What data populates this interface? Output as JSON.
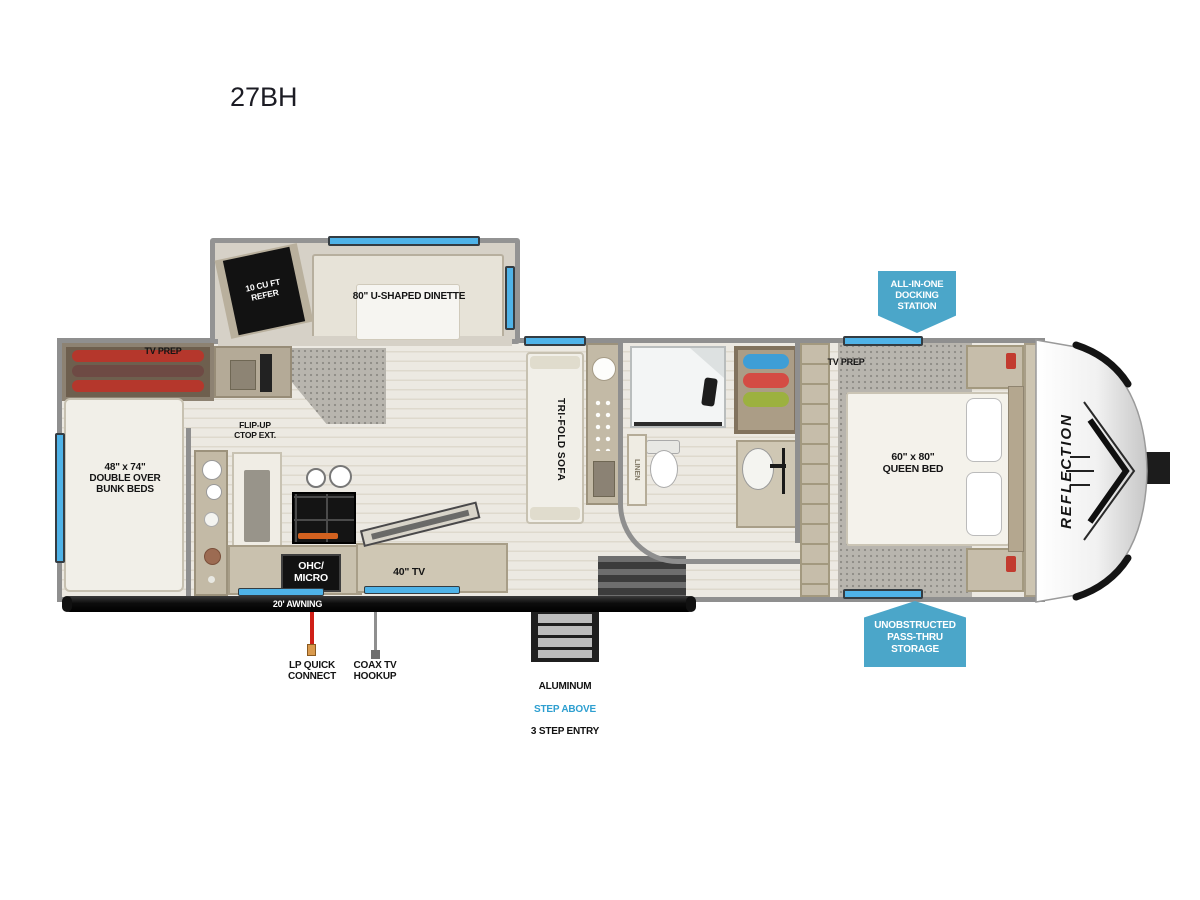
{
  "title": "27BH",
  "brand": "REFLECTION",
  "colors": {
    "badge_blue": "#4ba6c9",
    "window_blue": "#4fb3e8",
    "lp_red": "#cf1f17",
    "step_above_blue": "#2e9fd0"
  },
  "rooms": {
    "refer": [
      "10 CU FT",
      "REFER"
    ],
    "dinette": "80\" U-SHAPED DINETTE",
    "tv_prep_left": "TV PREP",
    "bunks": [
      "48\" x 74\"",
      "DOUBLE OVER",
      "BUNK BEDS"
    ],
    "flip_up": [
      "FLIP-UP",
      "CTOP EXT."
    ],
    "ohc_micro": [
      "OHC/",
      "MICRO"
    ],
    "tv40": "40\" TV",
    "sofa": "TRI-FOLD SOFA",
    "linen": "LINEN",
    "tv_prep_right": "TV PREP",
    "queen": [
      "60\" x 80\"",
      "QUEEN BED"
    ],
    "awning": "20' AWNING"
  },
  "badges": {
    "docking": [
      "ALL-IN-ONE",
      "DOCKING",
      "STATION"
    ],
    "passthru": [
      "UNOBSTRUCTED",
      "PASS-THRU",
      "STORAGE"
    ]
  },
  "callouts": {
    "lp": [
      "LP QUICK",
      "CONNECT"
    ],
    "coax": [
      "COAX TV",
      "HOOKUP"
    ],
    "entry_line1": "ALUMINUM",
    "entry_line2": "STEP ABOVE",
    "entry_line3": "3 STEP ENTRY"
  }
}
